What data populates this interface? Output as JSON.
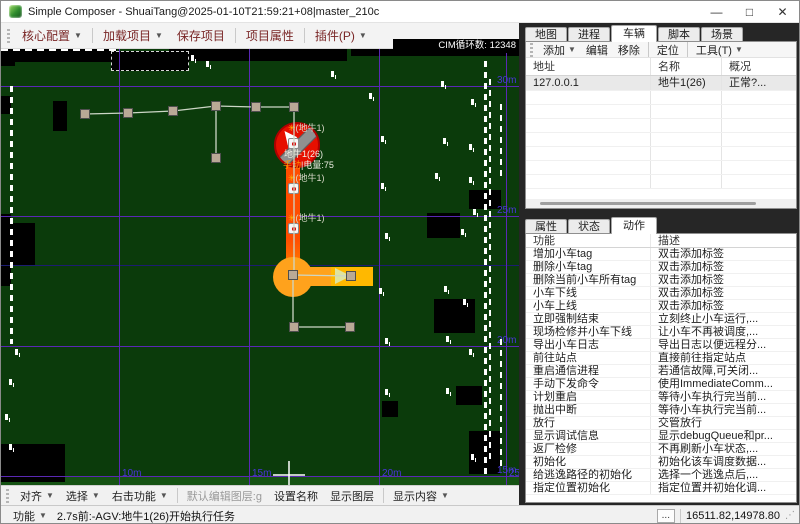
{
  "window": {
    "title": "Simple Composer - ShuaiTang@2025-01-10T21:59:21+08|master_210c",
    "controls": {
      "minimize": "—",
      "maximize": "□",
      "close": "✕"
    }
  },
  "menubar": {
    "items": [
      {
        "label": "核心配置",
        "dropdown": true,
        "sep_after": true
      },
      {
        "label": "加载项目",
        "dropdown": true,
        "sep_after": false
      },
      {
        "label": "保存项目",
        "dropdown": false,
        "sep_after": true
      },
      {
        "label": "项目属性",
        "dropdown": false,
        "sep_after": true
      },
      {
        "label": "插件(P)",
        "dropdown": true,
        "sep_after": false
      }
    ]
  },
  "map": {
    "cim_label": "CIM循环数: 12348",
    "colors": {
      "bg": "#0b3b0b",
      "bg_light_strip": "#155213",
      "grid": "#5a28b4",
      "grid_label": "#4a35d8",
      "boundary": "#1c1c72",
      "route_line": "#ccd6c6",
      "node_fill": "#b9a996",
      "node_stroke": "#4f4f4f",
      "path_hot": "#ff4d00",
      "path_mid": "#ff9100",
      "path_warm": "#ffa21c",
      "path_bright": "#ffb800",
      "arrow_fill": "#dfe39e",
      "agv_red": "#e60f00",
      "agv_ring": "#b00000",
      "agv_band": "#909090",
      "label_text": "#d9d9c9",
      "label_star": "#ffb300",
      "battery_orange": "#ff9d00"
    },
    "v_gridlines": [
      {
        "x": 118,
        "label": "10m"
      },
      {
        "x": 248,
        "label": "15m"
      },
      {
        "x": 378,
        "label": "20m"
      },
      {
        "x": 505,
        "label": "25m"
      }
    ],
    "h_gridlines": [
      {
        "y": 37,
        "label": "30m"
      },
      {
        "y": 167,
        "label": "25m"
      },
      {
        "y": 297,
        "label": "20m"
      },
      {
        "y": 427,
        "label": "15m"
      }
    ],
    "boundary_line_y": 216,
    "black_patches": [
      [
        0,
        0,
        116,
        13
      ],
      [
        168,
        0,
        178,
        12
      ],
      [
        350,
        0,
        168,
        7
      ],
      [
        0,
        2,
        14,
        15
      ],
      [
        0,
        47,
        10,
        18
      ],
      [
        52,
        52,
        14,
        30
      ],
      [
        0,
        165,
        10,
        72
      ],
      [
        8,
        174,
        26,
        42
      ],
      [
        0,
        395,
        64,
        38
      ],
      [
        468,
        141,
        32,
        19
      ],
      [
        426,
        164,
        33,
        25
      ],
      [
        433,
        250,
        41,
        34
      ],
      [
        455,
        337,
        26,
        19
      ],
      [
        468,
        382,
        31,
        43
      ],
      [
        381,
        352,
        16,
        16
      ]
    ],
    "room_outline": {
      "x": 110,
      "y": 2,
      "w": 78,
      "h": 20
    },
    "walls": [
      {
        "x": 9,
        "y1": 37,
        "y2": 295,
        "w": 3
      },
      {
        "x": 483,
        "y1": 12,
        "y2": 427,
        "w": 3
      },
      {
        "x": 488,
        "y1": 30,
        "y2": 410,
        "w": 2
      },
      {
        "x": 499,
        "y1": 55,
        "y2": 130,
        "w": 2
      },
      {
        "x": 499,
        "y1": 290,
        "y2": 420,
        "w": 2
      }
    ],
    "noise_marks": [
      [
        368,
        44
      ],
      [
        440,
        32
      ],
      [
        380,
        87
      ],
      [
        442,
        89
      ],
      [
        468,
        95
      ],
      [
        380,
        134
      ],
      [
        434,
        124
      ],
      [
        468,
        128
      ],
      [
        384,
        184
      ],
      [
        378,
        239
      ],
      [
        443,
        237
      ],
      [
        384,
        289
      ],
      [
        445,
        287
      ],
      [
        384,
        340
      ],
      [
        445,
        339
      ],
      [
        190,
        6
      ],
      [
        205,
        12
      ],
      [
        330,
        22
      ],
      [
        14,
        300
      ],
      [
        8,
        330
      ],
      [
        4,
        365
      ],
      [
        8,
        395
      ],
      [
        470,
        50
      ],
      [
        472,
        160
      ],
      [
        468,
        300
      ],
      [
        470,
        405
      ],
      [
        460,
        180
      ],
      [
        462,
        250
      ]
    ],
    "route": {
      "segments": [
        [
          84,
          65,
          127,
          64
        ],
        [
          127,
          64,
          172,
          62
        ],
        [
          172,
          62,
          215,
          57
        ],
        [
          215,
          57,
          255,
          58
        ],
        [
          255,
          58,
          293,
          58
        ],
        [
          215,
          57,
          215,
          109
        ],
        [
          293,
          58,
          293,
          226
        ],
        [
          292,
          226,
          292,
          278
        ],
        [
          292,
          226,
          350,
          227
        ],
        [
          293,
          278,
          349,
          278
        ]
      ],
      "nodes": [
        [
          84,
          65
        ],
        [
          127,
          64
        ],
        [
          172,
          62
        ],
        [
          215,
          57
        ],
        [
          255,
          58
        ],
        [
          293,
          58
        ],
        [
          215,
          109
        ],
        [
          292,
          226
        ],
        [
          350,
          227
        ],
        [
          293,
          278
        ],
        [
          349,
          278
        ]
      ]
    },
    "task_path": {
      "vert_hot": [
        285,
        102,
        14,
        88
      ],
      "vert_mid": [
        285,
        190,
        14,
        42
      ],
      "corner": {
        "cx": 292,
        "cy": 228,
        "r": 20
      },
      "horiz": [
        293,
        218,
        79,
        19
      ],
      "horiz_bright": [
        330,
        218,
        42,
        19
      ],
      "arrow_tip": [
        [
          334,
          219
        ],
        [
          350,
          227
        ],
        [
          334,
          235
        ]
      ]
    },
    "agv": {
      "cx": 296,
      "cy": 96,
      "r": 23,
      "tag": "(地牛1)",
      "star": "✳",
      "name_label": "地牛1(26)",
      "mode_label": "手动",
      "battery_label": "|电量:75"
    },
    "waypoint_labels": [
      {
        "x": 287,
        "y": 74
      },
      {
        "x": 287,
        "y": 124
      },
      {
        "x": 287,
        "y": 164
      }
    ],
    "waypoint_icons": [
      [
        287,
        89
      ],
      [
        287,
        134
      ],
      [
        287,
        174
      ]
    ],
    "crosshair": {
      "x": 288,
      "y": 426,
      "arm": 16
    }
  },
  "vehicle_panel": {
    "tabs": [
      {
        "label": "地图",
        "active": false
      },
      {
        "label": "进程",
        "active": false
      },
      {
        "label": "车辆",
        "active": true
      },
      {
        "label": "脚本",
        "active": false
      },
      {
        "label": "场景",
        "active": false
      }
    ],
    "toolbar": [
      {
        "label": "添加",
        "dropdown": true,
        "sep_after": false
      },
      {
        "label": "编辑",
        "dropdown": false,
        "sep_after": false
      },
      {
        "label": "移除",
        "dropdown": false,
        "sep_after": true
      },
      {
        "label": "定位",
        "dropdown": false,
        "sep_after": true
      },
      {
        "label": "工具(T)",
        "dropdown": true,
        "sep_after": false
      }
    ],
    "table": {
      "headers": [
        "地址",
        "名称",
        "概况"
      ],
      "rows": [
        [
          "127.0.0.1",
          "地牛1(26)",
          "正常?..."
        ]
      ],
      "empty_row_count": 7
    }
  },
  "action_panel": {
    "tabs": [
      {
        "label": "属性",
        "active": false
      },
      {
        "label": "状态",
        "active": false
      },
      {
        "label": "动作",
        "active": true
      }
    ],
    "table": {
      "headers": [
        "功能",
        "描述"
      ],
      "rows": [
        [
          "增加小车tag",
          "双击添加标签"
        ],
        [
          "删除小车tag",
          "双击添加标签"
        ],
        [
          "删除当前小车所有tag",
          "双击添加标签"
        ],
        [
          "小车下线",
          "双击添加标签"
        ],
        [
          "小车上线",
          "双击添加标签"
        ],
        [
          "立即强制结束",
          "立刻终止小车运行,..."
        ],
        [
          "现场检修并小车下线",
          "让小车不再被调度,..."
        ],
        [
          "导出小车日志",
          "导出日志以便远程分..."
        ],
        [
          "前往站点",
          "直接前往指定站点"
        ],
        [
          "重启通信进程",
          "若通信故障,可关闭..."
        ],
        [
          "手动下发命令",
          "使用ImmediateComm..."
        ],
        [
          "计划重启",
          "等待小车执行完当前..."
        ],
        [
          "抛出中断",
          "等待小车执行完当前..."
        ],
        [
          "放行",
          "交管放行"
        ],
        [
          "显示调试信息",
          "显示debugQueue和pr..."
        ],
        [
          "返厂检修",
          "不再刷新小车状态,..."
        ],
        [
          "初始化",
          "初始化该车调度数据..."
        ],
        [
          "给逃逸路径的初始化",
          "选择一个逃逸点后,..."
        ],
        [
          "指定位置初始化",
          "指定位置并初始化调..."
        ]
      ]
    }
  },
  "edit_toolbar": {
    "items": [
      {
        "label": "对齐",
        "dropdown": true,
        "disabled": false,
        "sep_after": false
      },
      {
        "label": "选择",
        "dropdown": true,
        "disabled": false,
        "sep_after": false
      },
      {
        "label": "右击功能",
        "dropdown": true,
        "disabled": false,
        "sep_after": true
      },
      {
        "label": "默认编辑图层:g",
        "dropdown": false,
        "disabled": true,
        "sep_after": false
      },
      {
        "label": "设置名称",
        "dropdown": false,
        "disabled": false,
        "sep_after": false
      },
      {
        "label": "显示图层",
        "dropdown": false,
        "disabled": false,
        "sep_after": true
      },
      {
        "label": "显示内容",
        "dropdown": true,
        "disabled": false,
        "sep_after": false
      }
    ]
  },
  "statusbar": {
    "menu_label": "功能",
    "message": "2.7s前:-AGV:地牛1(26)开始执行任务",
    "more_button": "...",
    "coordinates": "16511.82,14978.80"
  }
}
